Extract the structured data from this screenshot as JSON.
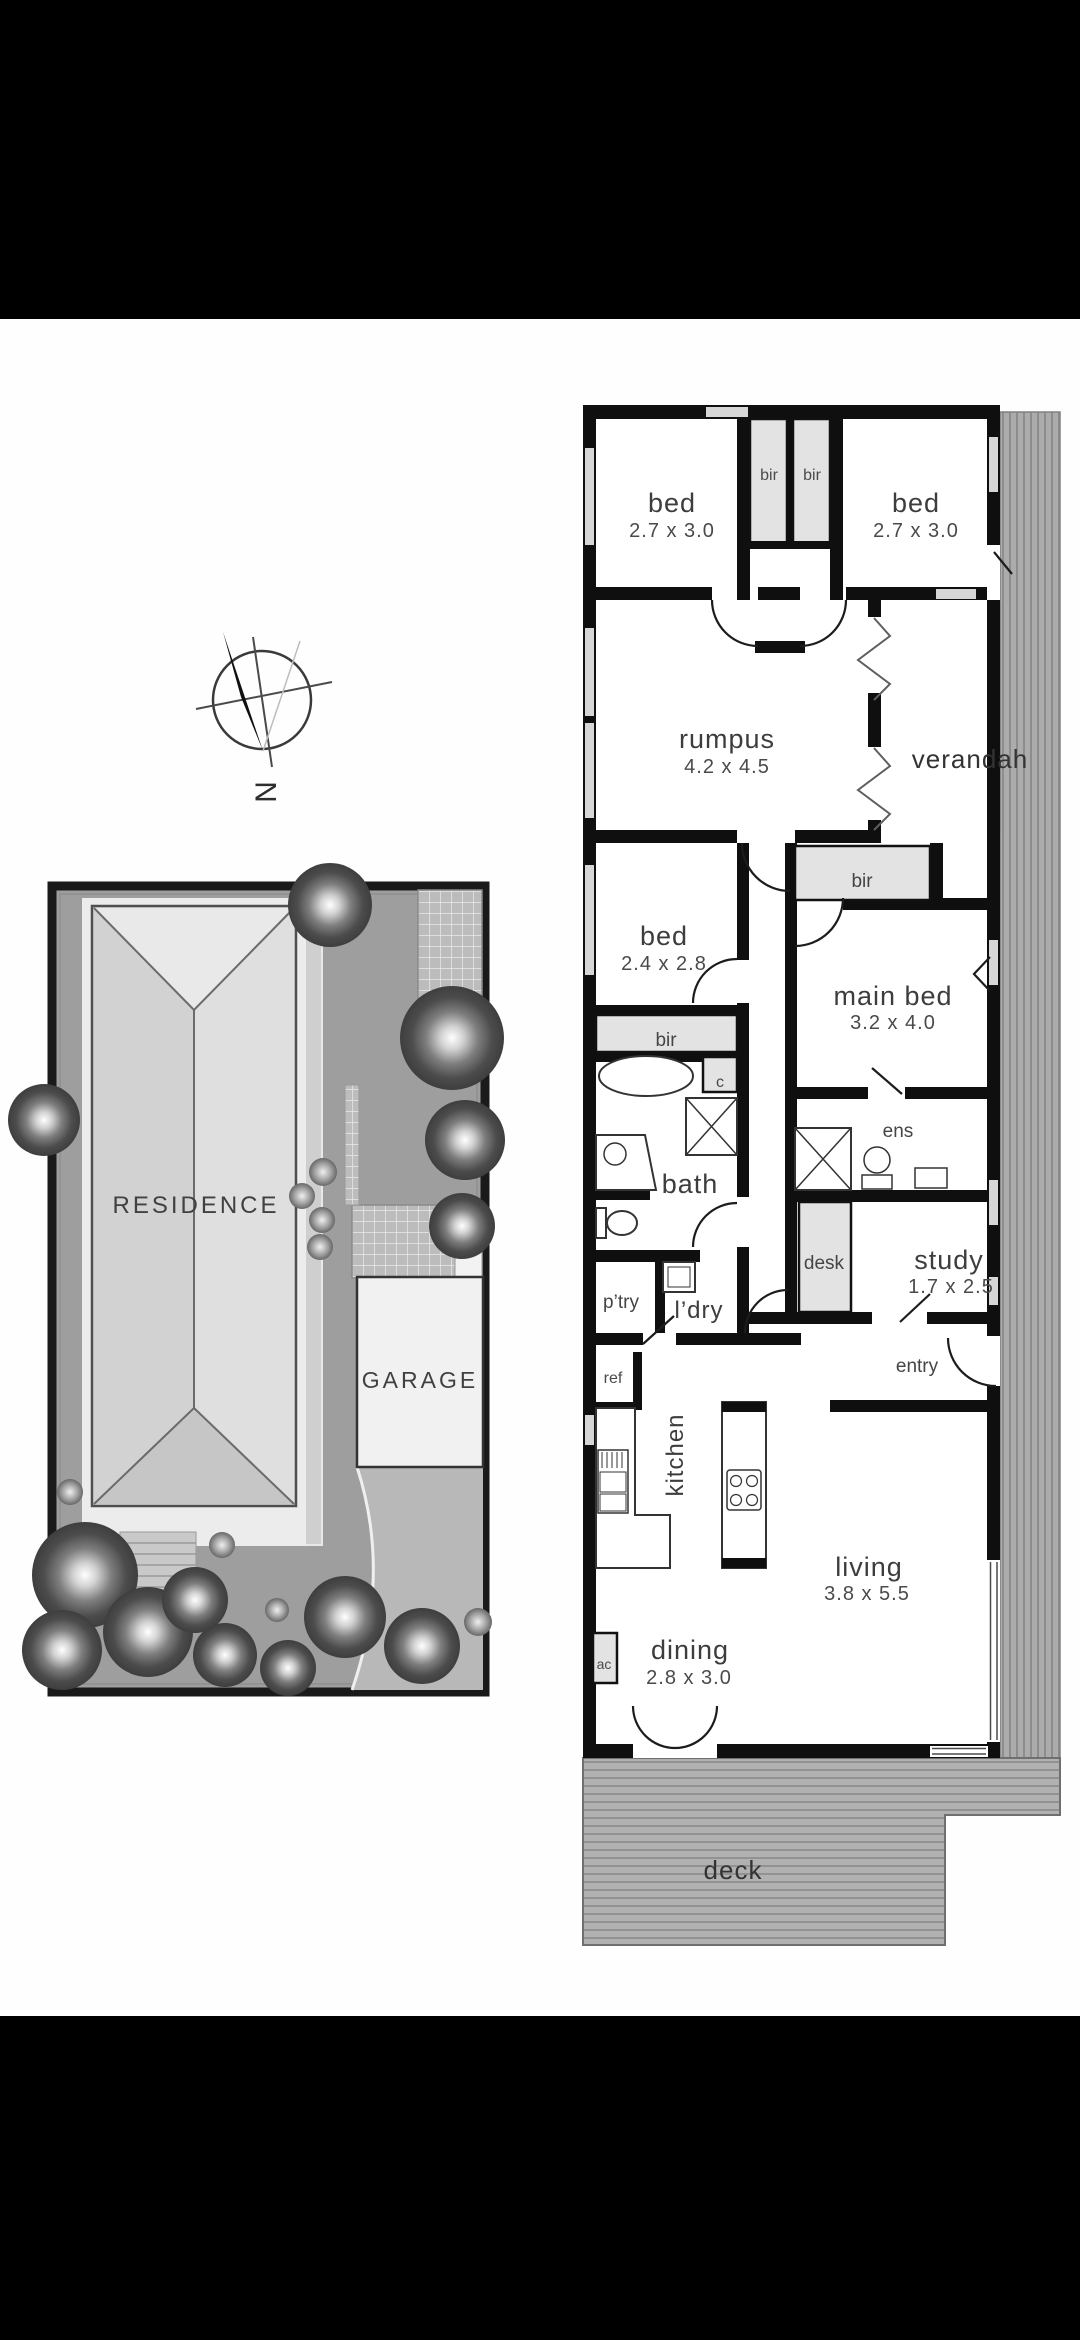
{
  "compass": {
    "north_label": "N"
  },
  "site_plan": {
    "residence_label": "RESIDENCE",
    "garage_label": "GARAGE"
  },
  "floor_plan": {
    "bed1": {
      "name": "bed",
      "dims": "2.7 x 3.0"
    },
    "bed2": {
      "name": "bed",
      "dims": "2.7 x 3.0"
    },
    "bir_top_left": {
      "name": "bir"
    },
    "bir_top_right": {
      "name": "bir"
    },
    "rumpus": {
      "name": "rumpus",
      "dims": "4.2 x 4.5"
    },
    "verandah": {
      "name": "verandah"
    },
    "bed3": {
      "name": "bed",
      "dims": "2.4 x 2.8"
    },
    "bir_main": {
      "name": "bir"
    },
    "main_bed": {
      "name": "main bed",
      "dims": "3.2 x 4.0"
    },
    "bir_bed3": {
      "name": "bir"
    },
    "closet": {
      "name": "c"
    },
    "bath": {
      "name": "bath"
    },
    "ens": {
      "name": "ens"
    },
    "desk": {
      "name": "desk"
    },
    "study": {
      "name": "study",
      "dims": "1.7 x 2.5"
    },
    "pantry": {
      "name": "p’try"
    },
    "laundry": {
      "name": "l’dry"
    },
    "ref": {
      "name": "ref"
    },
    "entry": {
      "name": "entry"
    },
    "kitchen": {
      "name": "kitchen"
    },
    "living": {
      "name": "living",
      "dims": "3.8 x 5.5"
    },
    "dining": {
      "name": "dining",
      "dims": "2.8 x 3.0"
    },
    "ac": {
      "name": "ac"
    },
    "deck": {
      "name": "deck"
    }
  },
  "colors": {
    "letterbox_bar": "#000000",
    "paper": "#ffffff",
    "wall": "#0f0f0f",
    "outdoor_gray": "#ababab",
    "closet_gray": "#e3e3e3",
    "yard_gray": "#9e9e9e"
  }
}
